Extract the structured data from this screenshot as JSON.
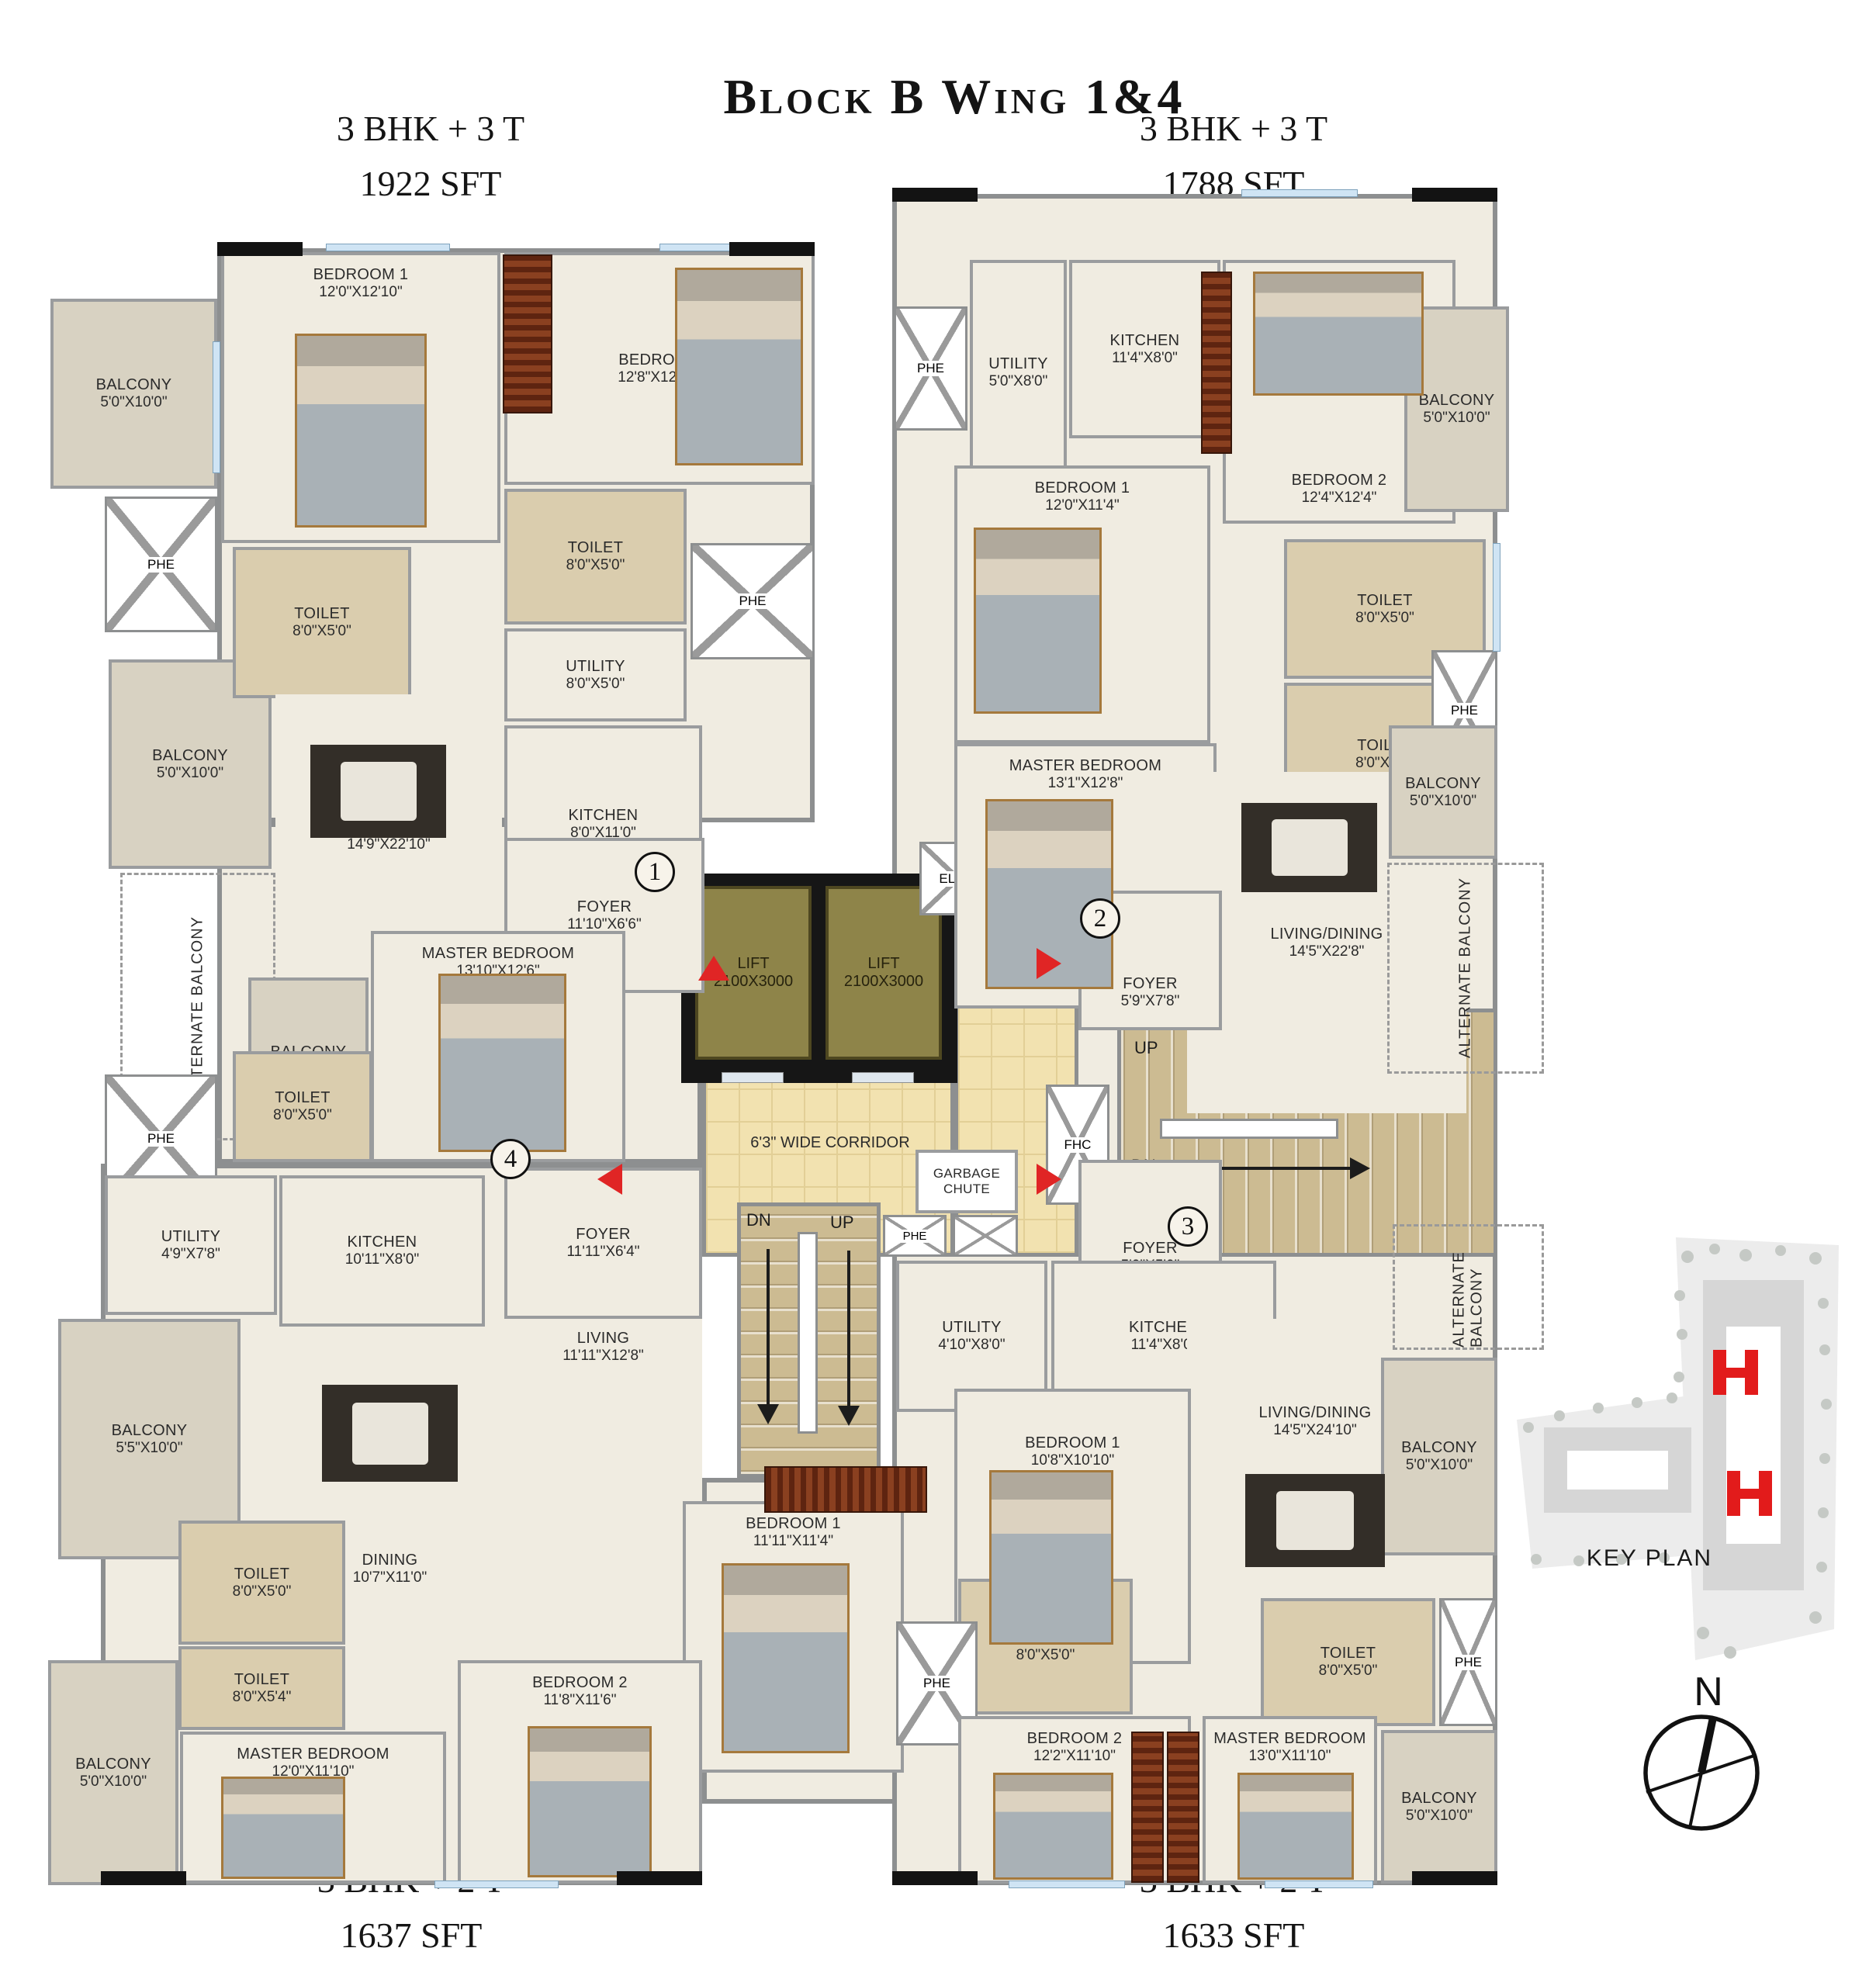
{
  "title": "Block B Wing 1&4",
  "labels": {
    "phe": "PHE",
    "alternate_balcony": "ALTERNATE BALCONY"
  },
  "units": {
    "u1": {
      "number": "1",
      "type": "3 BHK + 3 T",
      "area": "1922 SFT",
      "rooms": {
        "balcony1": {
          "name": "BALCONY",
          "dims": "5'0\"X10'0\""
        },
        "bedroom1": {
          "name": "BEDROOM 1",
          "dims": "12'0\"X12'10\""
        },
        "bedroom": {
          "name": "BEDROOM",
          "dims": "12'8\"X12'10\""
        },
        "toilet_left": {
          "name": "TOILET",
          "dims": "8'0\"X5'0\""
        },
        "toilet_right": {
          "name": "TOILET",
          "dims": "8'0\"X5'0\""
        },
        "utility": {
          "name": "UTILITY",
          "dims": "8'0\"X5'0\""
        },
        "kitchen": {
          "name": "KITCHEN",
          "dims": "8'0\"X11'0\""
        },
        "balcony2": {
          "name": "BALCONY",
          "dims": "5'0\"X10'0\""
        },
        "living": {
          "name": "LIVING/DINING",
          "dims": "14'9\"X22'10\""
        },
        "foyer": {
          "name": "FOYER",
          "dims": "11'10\"X6'6\""
        },
        "balcony3": {
          "name": "BALCONY",
          "dims": "7'0\"X6'10\""
        },
        "master": {
          "name": "MASTER BEDROOM",
          "dims": "13'10\"X12'6\""
        },
        "toilet3": {
          "name": "TOILET",
          "dims": "8'0\"X5'0\""
        }
      }
    },
    "u2": {
      "number": "2",
      "type": "3 BHK + 3 T",
      "area": "1788 SFT",
      "rooms": {
        "utility": {
          "name": "UTILITY",
          "dims": "5'0\"X8'0\""
        },
        "kitchen": {
          "name": "KITCHEN",
          "dims": "11'4\"X8'0\""
        },
        "bedroom2": {
          "name": "BEDROOM 2",
          "dims": "12'4\"X12'4\""
        },
        "balcony_top": {
          "name": "BALCONY",
          "dims": "5'0\"X10'0\""
        },
        "bedroom1": {
          "name": "BEDROOM 1",
          "dims": "12'0\"X11'4\""
        },
        "toilet1": {
          "name": "TOILET",
          "dims": "8'0\"X5'0\""
        },
        "toilet2": {
          "name": "TOILET",
          "dims": "8'0\"X5'0\""
        },
        "master": {
          "name": "MASTER BEDROOM",
          "dims": "13'1\"X12'8\""
        },
        "living": {
          "name": "LIVING/DINING",
          "dims": "14'5\"X22'8\""
        },
        "balcony_mid": {
          "name": "BALCONY",
          "dims": "5'0\"X10'0\""
        },
        "foyer": {
          "name": "FOYER",
          "dims": "5'9\"X7'8\""
        }
      }
    },
    "u3": {
      "number": "3",
      "type": "3 BHK + 2 T",
      "area": "1633 SFT",
      "rooms": {
        "foyer": {
          "name": "FOYER",
          "dims": "5'9\"X5'0\""
        },
        "utility": {
          "name": "UTILITY",
          "dims": "4'10\"X8'0\""
        },
        "kitchen": {
          "name": "KITCHEN",
          "dims": "11'4\"X8'0\""
        },
        "living": {
          "name": "LIVING/DINING",
          "dims": "14'5\"X24'10\""
        },
        "bedroom1": {
          "name": "BEDROOM 1",
          "dims": "10'8\"X10'10\""
        },
        "toilet_left": {
          "name": "TOILET",
          "dims": "8'0\"X5'0\""
        },
        "toilet_right": {
          "name": "TOILET",
          "dims": "8'0\"X5'0\""
        },
        "bedroom2": {
          "name": "BEDROOM 2",
          "dims": "12'2\"X11'10\""
        },
        "master": {
          "name": "MASTER BEDROOM",
          "dims": "13'0\"X11'10\""
        },
        "balcony_mid": {
          "name": "BALCONY",
          "dims": "5'0\"X10'0\""
        },
        "balcony_bottom": {
          "name": "BALCONY",
          "dims": "5'0\"X10'0\""
        }
      }
    },
    "u4": {
      "number": "4",
      "type": "3 BHK + 2 T",
      "area": "1637 SFT",
      "rooms": {
        "utility": {
          "name": "UTILITY",
          "dims": "4'9\"X7'8\""
        },
        "kitchen": {
          "name": "KITCHEN",
          "dims": "10'11\"X8'0\""
        },
        "foyer": {
          "name": "FOYER",
          "dims": "11'11\"X6'4\""
        },
        "living": {
          "name": "LIVING",
          "dims": "11'11\"X12'8\""
        },
        "balcony_top": {
          "name": "BALCONY",
          "dims": "5'5\"X10'0\""
        },
        "dining": {
          "name": "DINING",
          "dims": "10'7\"X11'0\""
        },
        "toilet1": {
          "name": "TOILET",
          "dims": "8'0\"X5'0\""
        },
        "toilet2": {
          "name": "TOILET",
          "dims": "8'0\"X5'4\""
        },
        "bedroom1": {
          "name": "BEDROOM 1",
          "dims": "11'11\"X11'4\""
        },
        "master": {
          "name": "MASTER BEDROOM",
          "dims": "12'0\"X11'10\""
        },
        "bedroom2": {
          "name": "BEDROOM 2",
          "dims": "11'8\"X11'6\""
        },
        "balcony_bottom": {
          "name": "BALCONY",
          "dims": "5'0\"X10'0\""
        }
      }
    }
  },
  "core": {
    "lift1": {
      "name": "LIFT",
      "dims": "2100X3000"
    },
    "lift2": {
      "name": "LIFT",
      "dims": "2100X3000"
    },
    "corridor": "6'3\" WIDE CORRIDOR",
    "garbage_chute": "GARBAGE CHUTE",
    "elec": "ELEC.",
    "comm": "COMM",
    "fhc": "FHC",
    "stairs": {
      "up": "UP",
      "dn": "DN"
    }
  },
  "key_plan": {
    "label": "KEY PLAN"
  },
  "compass": {
    "label": "N"
  },
  "colors": {
    "wall": "#8d8f90",
    "floor": "#f0ece1",
    "corridor": "#f2e2b0",
    "lift": "#8e8449",
    "balcony": "#d8d2c2",
    "toilet": "#dacdae",
    "highlight": "#e01f1f"
  }
}
